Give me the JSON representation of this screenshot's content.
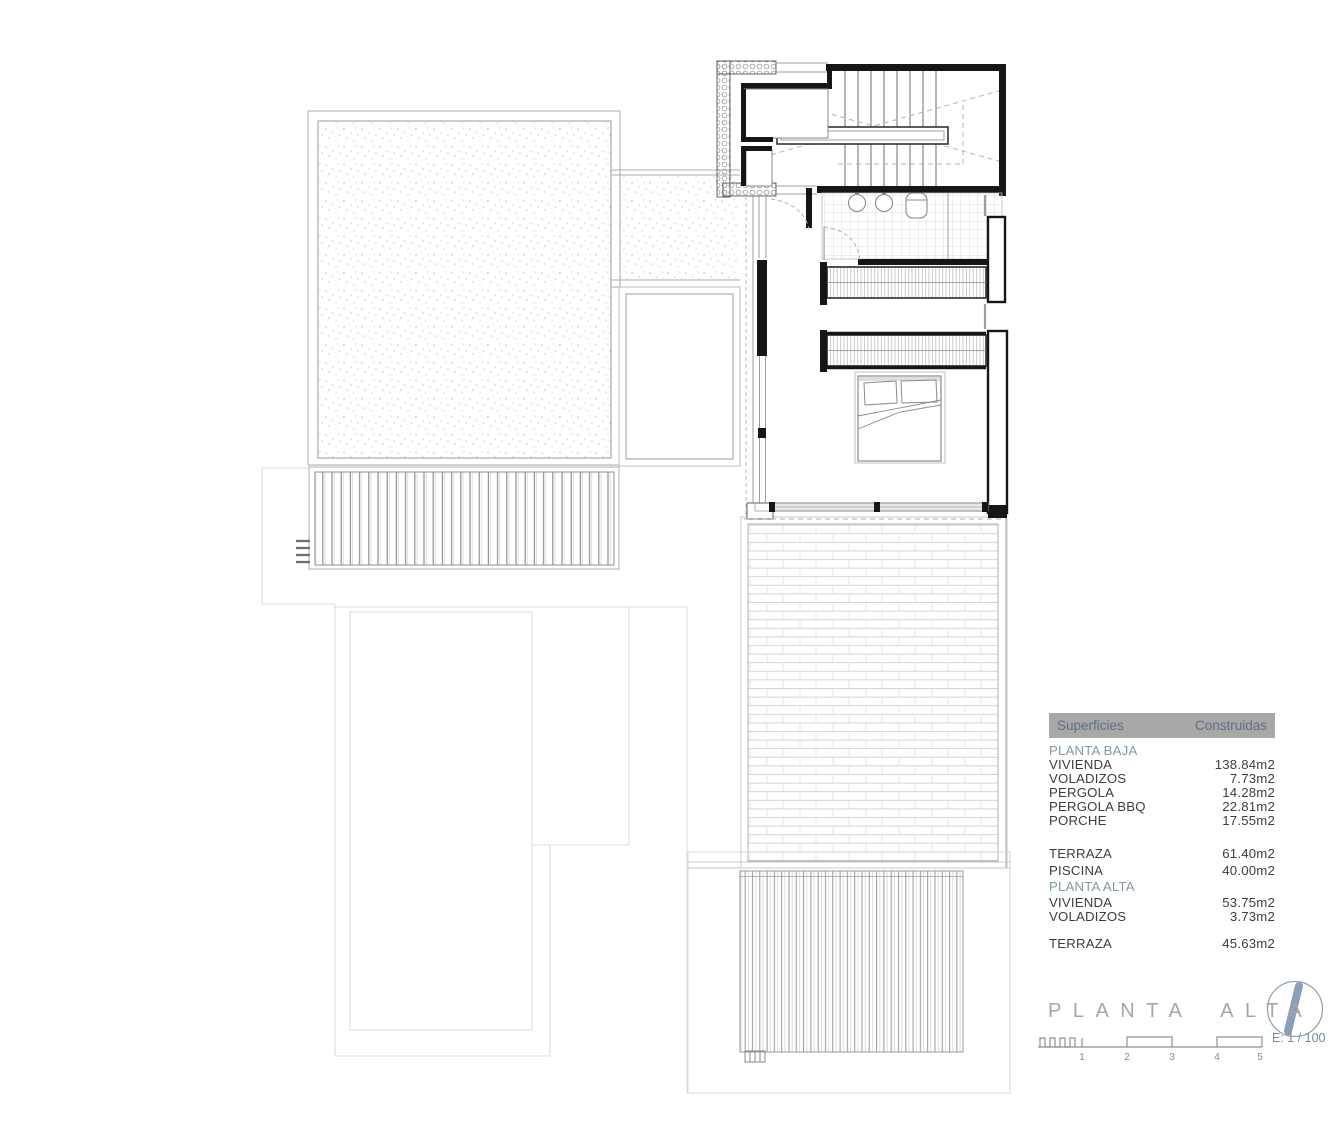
{
  "title": {
    "text": "PLANTA ALTA"
  },
  "areas_table": {
    "header": {
      "col_left": "Superficies",
      "col_right": "Construidas"
    },
    "rows": [
      {
        "kind": "section",
        "label": "PLANTA BAJA",
        "value": ""
      },
      {
        "kind": "item",
        "label": "VIVIENDA",
        "value": "138.84m2"
      },
      {
        "kind": "item",
        "label": "VOLADIZOS",
        "value": "7.73m2"
      },
      {
        "kind": "item",
        "label": "PERGOLA",
        "value": "14.28m2"
      },
      {
        "kind": "item",
        "label": "PERGOLA BBQ",
        "value": "22.81m2"
      },
      {
        "kind": "item",
        "label": "PORCHE",
        "value": "17.55m2"
      },
      {
        "kind": "item",
        "label": "TERRAZA",
        "value": "61.40m2"
      },
      {
        "kind": "item",
        "label": "PISCINA",
        "value": "40.00m2"
      },
      {
        "kind": "section",
        "label": "PLANTA ALTA",
        "value": ""
      },
      {
        "kind": "item",
        "label": "VIVIENDA",
        "value": "53.75m2"
      },
      {
        "kind": "item",
        "label": "VOLADIZOS",
        "value": "3.73m2"
      },
      {
        "kind": "item",
        "label": "TERRAZA",
        "value": "45.63m2"
      }
    ]
  },
  "scale_bar": {
    "numbers": [
      "1",
      "2",
      "3",
      "4",
      "5"
    ],
    "scale_label": "E: 1 / 100"
  },
  "compass": {
    "icon": "north-arrow-icon"
  },
  "colors": {
    "table_header_bg": "#a8a8a8",
    "table_header_text": "#5c6f88",
    "section_text": "#7f99a8",
    "row_text": "#3d3d3d",
    "title_text": "#a5a5a5",
    "scale_text": "#8f8f8f",
    "compass_accent": "#8aa0b6",
    "wall_line": "#161616"
  }
}
